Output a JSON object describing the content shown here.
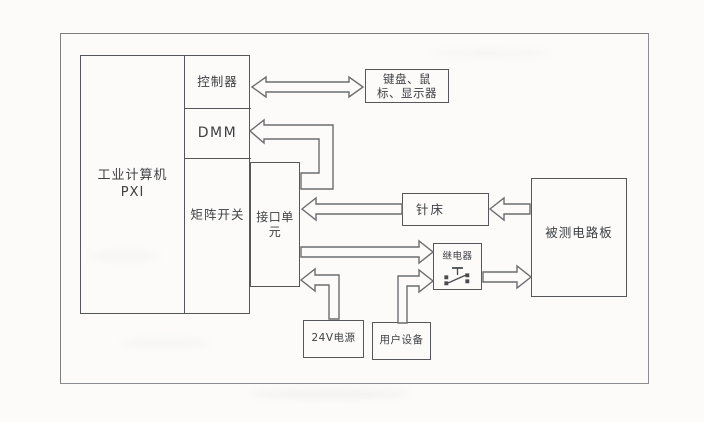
{
  "diagram": {
    "colors": {
      "line": "#55575b",
      "arrow_line": "#6b6d70",
      "text": "#3e4044",
      "background": "#fcfbfa"
    },
    "nodes": {
      "industrial_computer": {
        "lines": [
          "工业计算机",
          "PXI"
        ]
      },
      "controller": {
        "label": "控制器"
      },
      "dmm": {
        "label": "DMM"
      },
      "matrix_switch": {
        "label": "矩阵开关"
      },
      "interface_unit": {
        "lines": [
          "接口单",
          "元"
        ]
      },
      "keyboard_mouse_display": {
        "lines": [
          "键盘、鼠",
          "标、显示器"
        ]
      },
      "needle_bed": {
        "label": "针床"
      },
      "board_under_test": {
        "label": "被测电路板"
      },
      "relay": {
        "label": "继电器"
      },
      "power_24v": {
        "label": "24V电源"
      },
      "user_equipment": {
        "label": "用户设备"
      }
    },
    "connections": [
      {
        "from": "controller",
        "to": "keyboard_mouse_display",
        "type": "bidirectional-bus"
      },
      {
        "from": "interface_unit",
        "to": "dmm",
        "type": "bus-arrow"
      },
      {
        "from": "needle_bed",
        "to": "interface_unit",
        "type": "bus-arrow"
      },
      {
        "from": "board_under_test",
        "to": "needle_bed",
        "type": "bus-arrow"
      },
      {
        "from": "interface_unit",
        "to": "relay",
        "type": "bus-arrow"
      },
      {
        "from": "power_24v",
        "to": "interface_unit",
        "type": "bus-arrow"
      },
      {
        "from": "user_equipment",
        "to": "relay",
        "type": "bus-arrow"
      },
      {
        "from": "relay",
        "to": "board_under_test",
        "type": "bus-arrow"
      }
    ]
  }
}
